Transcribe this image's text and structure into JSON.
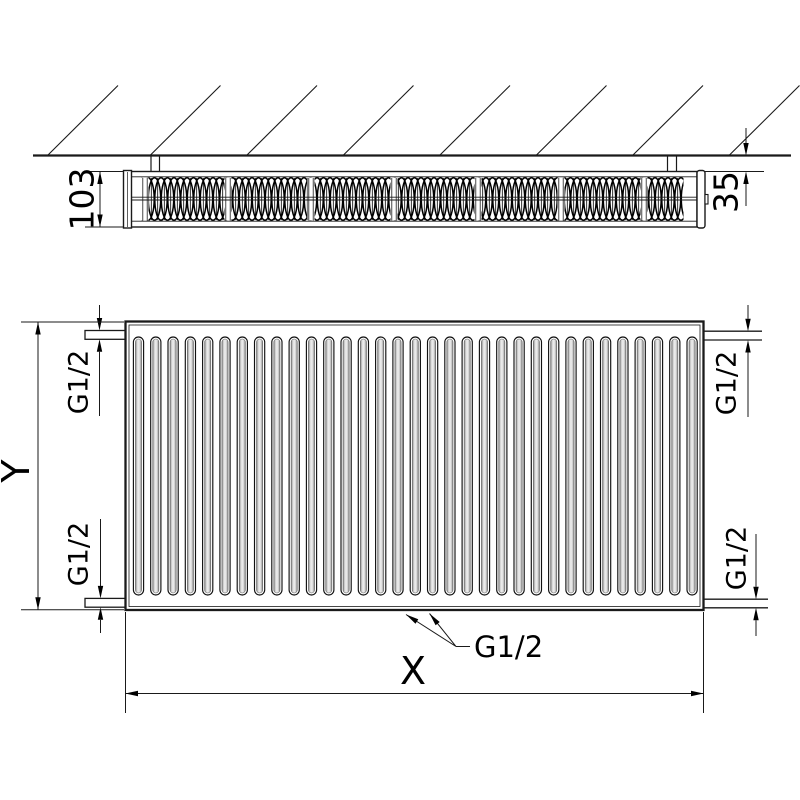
{
  "drawing": {
    "type": "radiator-technical-drawing",
    "views": {
      "top": {
        "depth_dimension": "103",
        "wall_distance_dimension": "35"
      },
      "front": {
        "height_dimension": "Y",
        "width_dimension": "X",
        "thread_top_left": "G1/2",
        "thread_top_right": "G1/2",
        "thread_bottom_left": "G1/2",
        "thread_bottom_right": "G1/2",
        "thread_bottom_center": "G1/2"
      }
    },
    "colors": {
      "line": "#1a1a1a",
      "background": "#ffffff",
      "groove_shade": "#9a9a9a"
    }
  }
}
